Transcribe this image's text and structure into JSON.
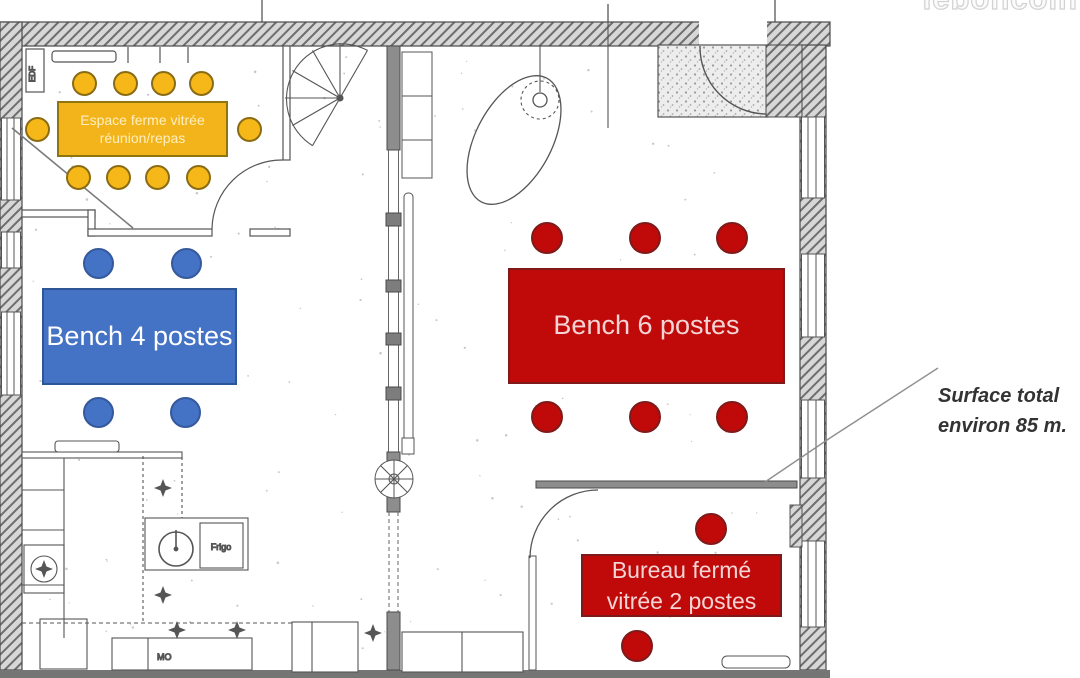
{
  "watermark": {
    "text": "leboncoin"
  },
  "surface_note": {
    "line1": "Surface total",
    "line2": "environ 85 m."
  },
  "zones": {
    "meeting_room": {
      "line1": "Espace ferme vitrée",
      "line2": "réunion/repas",
      "fill": "#F3B41B",
      "border": "#8F7510",
      "text_color": "#FDEFC0",
      "seats": 10,
      "seat_fill": "#F5B818",
      "seat_border": "#8A6C15"
    },
    "bench4": {
      "label": "Bench 4 postes",
      "fill": "#4472C4",
      "border": "#2E5597",
      "text_color": "#FFFFFF",
      "seats": 4,
      "seat_fill": "#4472C4",
      "seat_border": "#35599C"
    },
    "bench6": {
      "label": "Bench 6 postes",
      "fill": "#C00A0A",
      "border": "#7E1A1A",
      "text_color": "#F4D4D4",
      "seats": 6,
      "seat_fill": "#C00A0A",
      "seat_border": "#7E1A1A"
    },
    "bureau": {
      "line1": "Bureau fermé",
      "line2": "vitrée 2 postes",
      "fill": "#C00A0A",
      "border": "#7E1A1A",
      "text_color": "#F4D4D4",
      "seats": 2,
      "seat_fill": "#C00A0A",
      "seat_border": "#7E1A1A"
    }
  },
  "plan_labels": {
    "edf": "EDF",
    "frigo": "Frigo",
    "mo": "MO"
  }
}
